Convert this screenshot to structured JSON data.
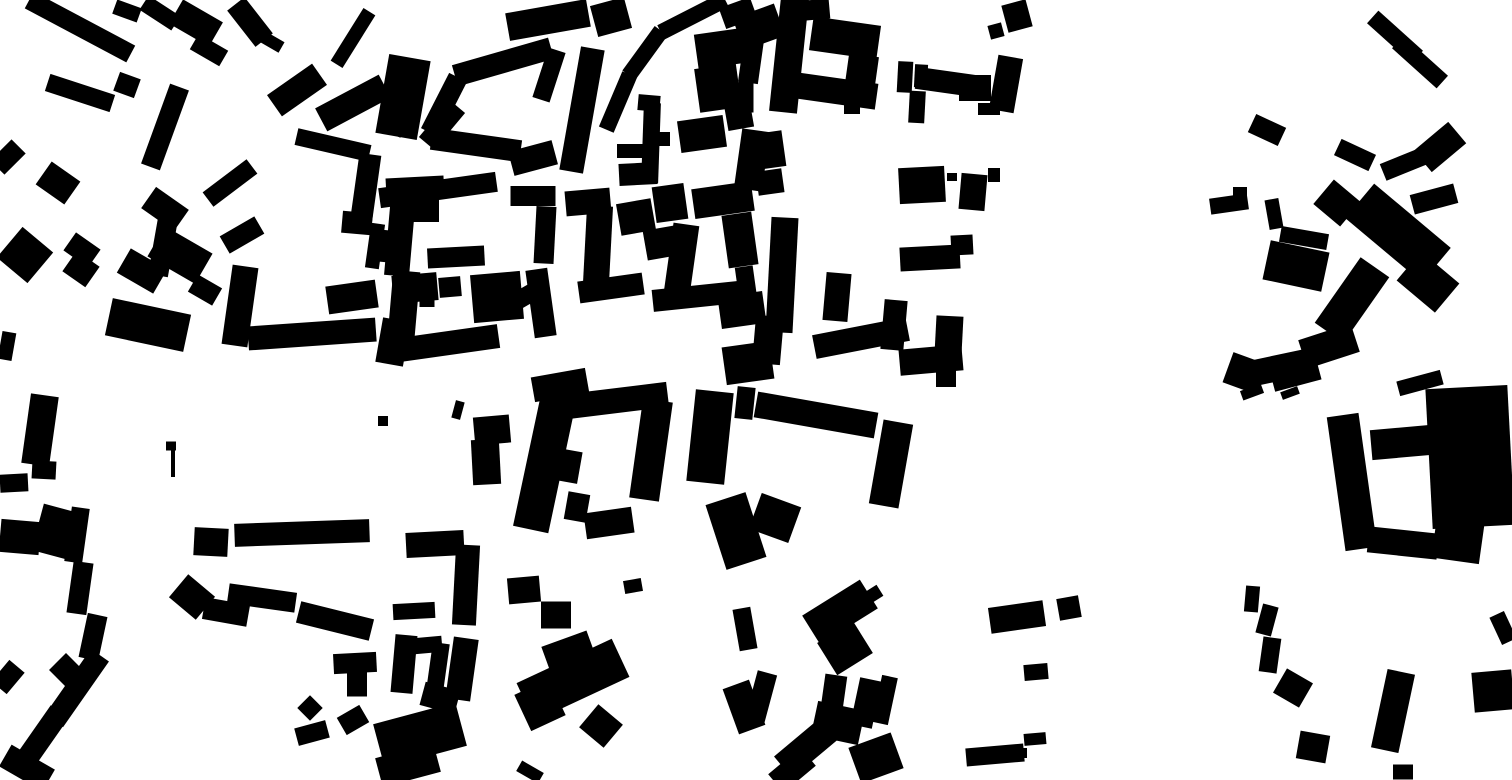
{
  "map": {
    "kind": "figure-ground",
    "description": "Black-and-white figure-ground (Nolli-style) map of urban building footprints; solid black building masses on a white ground, dense historic fabric at left/center, sparser blocks at right",
    "background_color": "#ffffff",
    "building_color": "#000000",
    "canvas": {
      "width": 1512,
      "height": 780
    },
    "buildings": [
      [
        80,
        27,
        115,
        19,
        28
      ],
      [
        127,
        11,
        26,
        15,
        20
      ],
      [
        160,
        13,
        38,
        17,
        33
      ],
      [
        196,
        23,
        46,
        28,
        30
      ],
      [
        209,
        50,
        34,
        18,
        30
      ],
      [
        250,
        22,
        46,
        22,
        52
      ],
      [
        272,
        42,
        22,
        12,
        30
      ],
      [
        353,
        38,
        62,
        14,
        -58
      ],
      [
        297,
        90,
        55,
        26,
        -35
      ],
      [
        353,
        103,
        72,
        26,
        -28
      ],
      [
        400,
        110,
        24,
        50,
        25
      ],
      [
        442,
        125,
        48,
        20,
        -50
      ],
      [
        333,
        145,
        75,
        17,
        13
      ],
      [
        365,
        193,
        22,
        78,
        8
      ],
      [
        357,
        223,
        30,
        22,
        5
      ],
      [
        415,
        187,
        58,
        20,
        -3
      ],
      [
        425,
        208,
        28,
        28,
        0
      ],
      [
        80,
        93,
        68,
        18,
        18
      ],
      [
        127,
        85,
        22,
        20,
        20
      ],
      [
        165,
        127,
        20,
        85,
        20
      ],
      [
        8,
        157,
        20,
        30,
        45
      ],
      [
        58,
        183,
        35,
        28,
        35
      ],
      [
        165,
        209,
        40,
        26,
        35
      ],
      [
        163,
        247,
        20,
        58,
        10
      ],
      [
        230,
        183,
        55,
        18,
        -37
      ],
      [
        242,
        235,
        40,
        20,
        -30
      ],
      [
        25,
        255,
        40,
        40,
        40
      ],
      [
        82,
        250,
        30,
        22,
        35
      ],
      [
        81,
        269,
        28,
        25,
        35
      ],
      [
        142,
        271,
        42,
        28,
        30
      ],
      [
        180,
        255,
        55,
        35,
        30
      ],
      [
        205,
        290,
        28,
        20,
        30
      ],
      [
        148,
        325,
        80,
        38,
        12
      ],
      [
        240,
        306,
        26,
        80,
        8
      ],
      [
        312,
        334,
        128,
        24,
        -4
      ],
      [
        352,
        297,
        50,
        28,
        -8
      ],
      [
        7,
        346,
        14,
        28,
        10
      ],
      [
        375,
        246,
        14,
        45,
        8
      ],
      [
        548,
        20,
        82,
        28,
        -10
      ],
      [
        611,
        17,
        35,
        32,
        -15
      ],
      [
        693,
        16,
        72,
        16,
        -27
      ],
      [
        645,
        53,
        55,
        16,
        -54
      ],
      [
        618,
        102,
        60,
        16,
        -67
      ],
      [
        403,
        97,
        42,
        80,
        10
      ],
      [
        444,
        105,
        62,
        20,
        -63
      ],
      [
        503,
        62,
        100,
        22,
        -16
      ],
      [
        549,
        75,
        18,
        52,
        18
      ],
      [
        533,
        158,
        45,
        25,
        -15
      ],
      [
        476,
        145,
        90,
        22,
        8
      ],
      [
        582,
        110,
        24,
        125,
        10
      ],
      [
        725,
        48,
        58,
        35,
        -8
      ],
      [
        738,
        13,
        33,
        22,
        -20
      ],
      [
        759,
        27,
        44,
        34,
        -20
      ],
      [
        751,
        61,
        20,
        44,
        8
      ],
      [
        718,
        88,
        42,
        44,
        -8
      ],
      [
        746,
        95,
        15,
        35,
        0
      ],
      [
        738,
        110,
        26,
        38,
        -10
      ],
      [
        752,
        160,
        28,
        60,
        8
      ],
      [
        649,
        103,
        22,
        16,
        5
      ],
      [
        651,
        143,
        17,
        80,
        2
      ],
      [
        630,
        151,
        26,
        14,
        0
      ],
      [
        638,
        174,
        38,
        22,
        -3
      ],
      [
        664,
        139,
        12,
        14,
        0
      ],
      [
        702,
        134,
        46,
        32,
        -8
      ],
      [
        438,
        190,
        118,
        20,
        -8
      ],
      [
        400,
        236,
        25,
        80,
        5
      ],
      [
        384,
        246,
        12,
        32,
        5
      ],
      [
        456,
        257,
        57,
        20,
        -3
      ],
      [
        545,
        235,
        20,
        57,
        3
      ],
      [
        533,
        196,
        45,
        20,
        0
      ],
      [
        588,
        202,
        45,
        25,
        -5
      ],
      [
        598,
        245,
        26,
        78,
        3
      ],
      [
        611,
        288,
        65,
        22,
        -8
      ],
      [
        636,
        217,
        35,
        32,
        -10
      ],
      [
        661,
        243,
        32,
        30,
        -10
      ],
      [
        670,
        203,
        32,
        36,
        -8
      ],
      [
        723,
        200,
        60,
        30,
        -8
      ],
      [
        681,
        263,
        26,
        78,
        8
      ],
      [
        700,
        296,
        95,
        22,
        -6
      ],
      [
        742,
        310,
        45,
        32,
        -8
      ],
      [
        740,
        240,
        30,
        53,
        -8
      ],
      [
        746,
        283,
        18,
        33,
        -8
      ],
      [
        403,
        315,
        27,
        88,
        5
      ],
      [
        415,
        288,
        45,
        28,
        -5
      ],
      [
        450,
        287,
        22,
        20,
        -5
      ],
      [
        497,
        297,
        50,
        48,
        -5
      ],
      [
        524,
        297,
        22,
        18,
        -30
      ],
      [
        541,
        303,
        22,
        68,
        -8
      ],
      [
        449,
        343,
        100,
        24,
        -8
      ],
      [
        427,
        302,
        15,
        10,
        0
      ],
      [
        393,
        342,
        28,
        45,
        10
      ],
      [
        560,
        385,
        55,
        25,
        -10
      ],
      [
        789,
        55,
        28,
        115,
        6
      ],
      [
        812,
        10,
        35,
        20,
        -5
      ],
      [
        845,
        38,
        68,
        34,
        8
      ],
      [
        836,
        91,
        82,
        26,
        8
      ],
      [
        862,
        70,
        30,
        30,
        8
      ],
      [
        852,
        108,
        16,
        12,
        0
      ],
      [
        905,
        77,
        15,
        31,
        3
      ],
      [
        921,
        76,
        13,
        23,
        3
      ],
      [
        917,
        107,
        16,
        32,
        3
      ],
      [
        946,
        82,
        60,
        22,
        8
      ],
      [
        975,
        88,
        32,
        26,
        0
      ],
      [
        989,
        109,
        22,
        12,
        0
      ],
      [
        1006,
        84,
        25,
        55,
        10
      ],
      [
        996,
        31,
        14,
        14,
        -15
      ],
      [
        1017,
        16,
        25,
        28,
        -15
      ],
      [
        770,
        150,
        28,
        36,
        -8
      ],
      [
        770,
        182,
        26,
        24,
        -8
      ],
      [
        922,
        185,
        46,
        36,
        -3
      ],
      [
        952,
        177,
        10,
        8,
        0
      ],
      [
        973,
        192,
        26,
        36,
        5
      ],
      [
        994,
        175,
        12,
        14,
        0
      ],
      [
        782,
        275,
        27,
        115,
        3
      ],
      [
        930,
        258,
        60,
        24,
        -3
      ],
      [
        962,
        245,
        22,
        20,
        -3
      ],
      [
        837,
        297,
        25,
        48,
        5
      ],
      [
        894,
        325,
        23,
        50,
        5
      ],
      [
        861,
        338,
        95,
        24,
        -11
      ],
      [
        949,
        335,
        27,
        38,
        3
      ],
      [
        931,
        360,
        63,
        26,
        -5
      ],
      [
        768,
        340,
        28,
        48,
        5
      ],
      [
        946,
        378,
        20,
        18,
        0
      ],
      [
        1395,
        37,
        60,
        17,
        42
      ],
      [
        1420,
        62,
        60,
        17,
        42
      ],
      [
        1267,
        130,
        33,
        20,
        25
      ],
      [
        1355,
        155,
        38,
        18,
        25
      ],
      [
        1404,
        164,
        45,
        18,
        -22
      ],
      [
        1440,
        147,
        45,
        28,
        -40
      ],
      [
        1434,
        199,
        45,
        20,
        -15
      ],
      [
        1229,
        204,
        38,
        16,
        -8
      ],
      [
        1240,
        194,
        14,
        14,
        0
      ],
      [
        1274,
        214,
        14,
        30,
        -10
      ],
      [
        1337,
        203,
        35,
        32,
        40
      ],
      [
        1398,
        233,
        100,
        45,
        40
      ],
      [
        1428,
        282,
        50,
        38,
        40
      ],
      [
        1304,
        238,
        48,
        16,
        10
      ],
      [
        1296,
        266,
        60,
        40,
        12
      ],
      [
        1352,
        300,
        35,
        80,
        35
      ],
      [
        1329,
        346,
        55,
        30,
        -18
      ],
      [
        1295,
        373,
        48,
        26,
        -15
      ],
      [
        1244,
        373,
        34,
        32,
        20
      ],
      [
        1278,
        368,
        75,
        26,
        -12
      ],
      [
        1420,
        383,
        45,
        15,
        -15
      ],
      [
        40,
        430,
        28,
        70,
        8
      ],
      [
        44,
        470,
        24,
        18,
        3
      ],
      [
        14,
        483,
        28,
        18,
        -3
      ],
      [
        20,
        537,
        40,
        33,
        5
      ],
      [
        57,
        532,
        40,
        48,
        15
      ],
      [
        77,
        535,
        18,
        55,
        8
      ],
      [
        80,
        588,
        20,
        52,
        8
      ],
      [
        93,
        637,
        20,
        45,
        12
      ],
      [
        77,
        688,
        22,
        80,
        35
      ],
      [
        66,
        670,
        24,
        24,
        45
      ],
      [
        42,
        737,
        22,
        62,
        35
      ],
      [
        27,
        768,
        50,
        25,
        30
      ],
      [
        8,
        677,
        20,
        28,
        40
      ],
      [
        171,
        446,
        10,
        9,
        0
      ],
      [
        173,
        463,
        4,
        28,
        0
      ],
      [
        211,
        542,
        34,
        28,
        3
      ],
      [
        302,
        533,
        135,
        23,
        -2
      ],
      [
        192,
        597,
        35,
        30,
        40
      ],
      [
        226,
        612,
        45,
        22,
        10
      ],
      [
        262,
        598,
        68,
        20,
        8
      ],
      [
        335,
        621,
        75,
        22,
        14
      ],
      [
        355,
        663,
        43,
        20,
        -3
      ],
      [
        357,
        683,
        20,
        27,
        0
      ],
      [
        310,
        708,
        18,
        18,
        45
      ],
      [
        312,
        733,
        32,
        18,
        -15
      ],
      [
        353,
        720,
        26,
        20,
        -30
      ],
      [
        458,
        410,
        9,
        18,
        15
      ],
      [
        383,
        421,
        10,
        10,
        0
      ],
      [
        492,
        430,
        36,
        28,
        -5
      ],
      [
        486,
        462,
        28,
        45,
        -3
      ],
      [
        545,
        462,
        36,
        138,
        12
      ],
      [
        613,
        401,
        110,
        25,
        -7
      ],
      [
        651,
        450,
        30,
        100,
        8
      ],
      [
        609,
        523,
        48,
        26,
        -8
      ],
      [
        568,
        466,
        24,
        32,
        10
      ],
      [
        577,
        507,
        22,
        28,
        10
      ],
      [
        710,
        437,
        38,
        92,
        6
      ],
      [
        745,
        403,
        18,
        32,
        6
      ],
      [
        748,
        363,
        48,
        38,
        -8
      ],
      [
        736,
        531,
        42,
        68,
        -18
      ],
      [
        435,
        544,
        58,
        25,
        -3
      ],
      [
        466,
        585,
        24,
        80,
        3
      ],
      [
        414,
        611,
        42,
        16,
        -3
      ],
      [
        524,
        590,
        32,
        26,
        -5
      ],
      [
        556,
        615,
        30,
        27,
        0
      ],
      [
        633,
        586,
        18,
        13,
        -10
      ],
      [
        404,
        664,
        22,
        58,
        5
      ],
      [
        428,
        645,
        28,
        16,
        -5
      ],
      [
        438,
        667,
        17,
        48,
        8
      ],
      [
        462,
        669,
        25,
        62,
        8
      ],
      [
        440,
        698,
        36,
        24,
        15
      ],
      [
        420,
        735,
        85,
        45,
        -15
      ],
      [
        408,
        765,
        60,
        30,
        -15
      ],
      [
        573,
        680,
        105,
        42,
        -25
      ],
      [
        568,
        650,
        48,
        24,
        -20
      ],
      [
        540,
        705,
        38,
        40,
        -25
      ],
      [
        601,
        726,
        32,
        30,
        40
      ],
      [
        530,
        772,
        25,
        12,
        30
      ],
      [
        745,
        629,
        18,
        42,
        -10
      ],
      [
        744,
        707,
        28,
        48,
        -20
      ],
      [
        816,
        415,
        122,
        26,
        10
      ],
      [
        891,
        464,
        30,
        85,
        10
      ],
      [
        775,
        518,
        42,
        38,
        20
      ],
      [
        840,
        612,
        68,
        34,
        -32
      ],
      [
        845,
        648,
        42,
        38,
        -32
      ],
      [
        874,
        594,
        14,
        13,
        -32
      ],
      [
        834,
        692,
        22,
        34,
        8
      ],
      [
        838,
        723,
        48,
        35,
        12
      ],
      [
        806,
        748,
        60,
        28,
        -40
      ],
      [
        792,
        770,
        42,
        24,
        -40
      ],
      [
        876,
        758,
        45,
        38,
        -20
      ],
      [
        866,
        703,
        22,
        48,
        12
      ],
      [
        885,
        700,
        16,
        48,
        12
      ],
      [
        761,
        697,
        20,
        50,
        15
      ],
      [
        1017,
        617,
        55,
        26,
        -8
      ],
      [
        1069,
        608,
        22,
        22,
        -10
      ],
      [
        1036,
        672,
        24,
        16,
        -5
      ],
      [
        1035,
        739,
        22,
        12,
        -5
      ],
      [
        995,
        755,
        58,
        18,
        -5
      ],
      [
        1017,
        753,
        20,
        10,
        0
      ],
      [
        1352,
        482,
        32,
        135,
        -8
      ],
      [
        1470,
        457,
        82,
        140,
        -3
      ],
      [
        1407,
        442,
        72,
        30,
        -5
      ],
      [
        1403,
        543,
        70,
        26,
        6
      ],
      [
        1458,
        540,
        48,
        42,
        8
      ],
      [
        1252,
        599,
        14,
        26,
        5
      ],
      [
        1267,
        620,
        16,
        30,
        15
      ],
      [
        1270,
        655,
        18,
        35,
        8
      ],
      [
        1293,
        688,
        30,
        28,
        30
      ],
      [
        1313,
        747,
        30,
        28,
        10
      ],
      [
        1393,
        711,
        28,
        80,
        12
      ],
      [
        1403,
        772,
        20,
        15,
        0
      ],
      [
        1503,
        628,
        16,
        30,
        -25
      ],
      [
        1493,
        691,
        40,
        40,
        -5
      ],
      [
        1252,
        392,
        22,
        10,
        -20
      ],
      [
        1290,
        393,
        18,
        8,
        -20
      ]
    ]
  }
}
